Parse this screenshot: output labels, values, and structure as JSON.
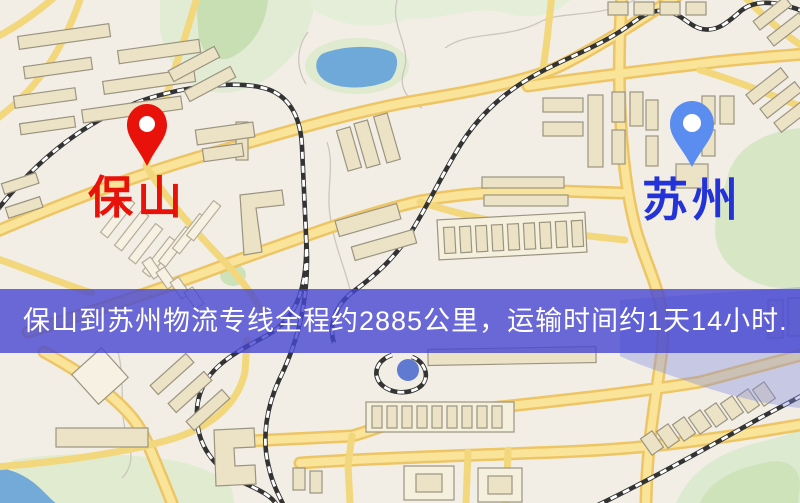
{
  "map": {
    "origin": {
      "name": "保山",
      "label_color": "#e8120a",
      "pin_color": "#e8120a",
      "pin_hole_color": "#ffffff"
    },
    "destination": {
      "name": "苏州",
      "label_color": "#2433d8",
      "pin_color": "#5b8cf0",
      "pin_hole_color": "#ffffff"
    },
    "banner": {
      "text": "保山到苏州物流专线全程约2885公里，运输时间约1天14小时.",
      "background_color": "rgba(70,70,210,0.8)",
      "text_color": "#ffffff"
    },
    "palette": {
      "background": "#f2eee6",
      "road_casing": "#eec564",
      "road_fill": "#f9e49a",
      "minor_road": "#f3d77d",
      "railway": "#333333",
      "water": "#6fa9d9",
      "park": "#dcead0",
      "building": "#ece3c7"
    }
  }
}
